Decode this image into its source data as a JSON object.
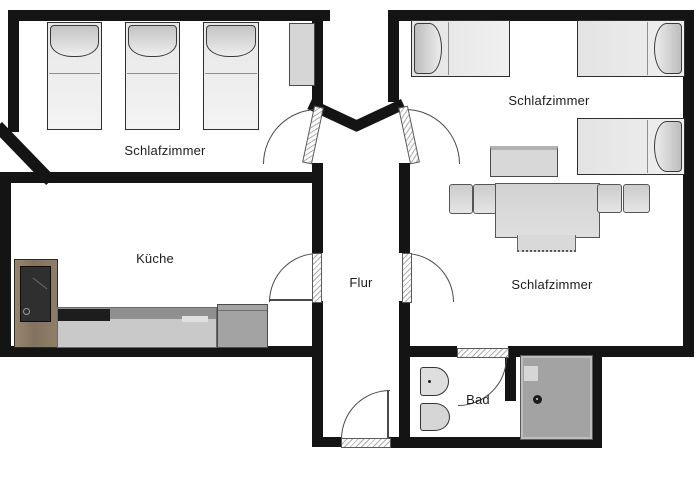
{
  "plan_type": "apartment-floorplan",
  "rooms": {
    "bedroom_top_left": {
      "label": "Schlafzimmer"
    },
    "bedroom_top_right": {
      "label": "Schlafzimmer"
    },
    "kitchen": {
      "label": "Küche"
    },
    "hallway": {
      "label": "Flur"
    },
    "bedroom_right": {
      "label": "Schlafzimmer"
    },
    "bathroom": {
      "label": "Bad"
    }
  },
  "furniture": {
    "bedroom_top_left": [
      "single-bed",
      "single-bed",
      "single-bed",
      "nightstand"
    ],
    "bedroom_top_right": [
      "single-bed",
      "single-bed",
      "single-bed",
      "table"
    ],
    "bedroom_right": [
      "sofa-bed-with-cushions"
    ],
    "kitchen": [
      "refrigerator",
      "kitchen-counter",
      "cooktop",
      "appliance"
    ],
    "bathroom": [
      "toilet",
      "bidet",
      "shower"
    ]
  },
  "doors": [
    "bedroom-top-left-door",
    "bedroom-top-right-door",
    "kitchen-door",
    "bedroom-right-door",
    "entrance-door",
    "bathroom-door"
  ],
  "colors": {
    "wall": "#141414",
    "background": "#ffffff",
    "furniture_light": "#f0f0f0",
    "furniture_gray": "#d8d8d8",
    "counter_gray": "#c9c9c9",
    "counter_dark": "#8f8f8f",
    "cooktop_black": "#1d1d1d",
    "wood_brown": "#8c7b65",
    "shower_gray": "#a3a3a3",
    "door_line": "#4a4a4a"
  }
}
